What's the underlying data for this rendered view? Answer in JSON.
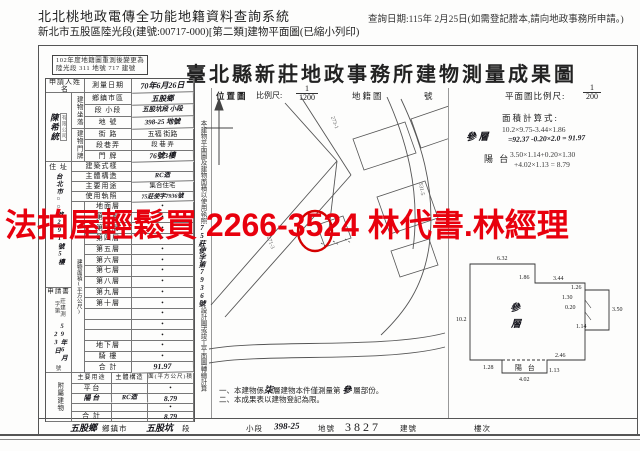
{
  "colors": {
    "watermark_red": "#e8000d",
    "circle_red": "#d40000",
    "ink": "#1c1c1c"
  },
  "page_header": {
    "system_title": "北北桃地政電傳全功能地籍資料查詢系統",
    "subtitle": "新北市五股區陸光段(建號:00717-000)[第二類]建物平面圖(已縮小列印)",
    "query_date": "查詢日期:115年 2月25日(如需登記謄本,請向地政事務所申請。)"
  },
  "watermark": {
    "text": "法拍屋輕鬆買 2266-3524 林代書.林經理"
  },
  "stamp": {
    "line1": "102年度地籍圖重測後變更為",
    "line2": "陸光段 311 地號 717 建號"
  },
  "form": {
    "title": "臺北縣新莊地政事務所建物測量成果圖",
    "map_header": {
      "loc": "位置圖",
      "scale_label": "比例尺:",
      "scale_num": "1",
      "scale_den": "1200",
      "cad": "地籍圖",
      "no": "號"
    },
    "plan_scale": {
      "label": "平面圖比例尺:",
      "num": "1",
      "den": "200"
    },
    "calc": {
      "title": "面積計算式:",
      "floor_label": "參 層",
      "floor_line1": "10.2×9.75-3.44×1.86",
      "floor_line2": "=92.37 -0.20×2.0 = 91.97",
      "balcony_label": "陽 台",
      "balcony_line1": "3.50×1.14+0.20×1.30",
      "balcony_line2": "+4.02×1.13 = 8.79"
    },
    "side_note": {
      "pre": "本建物平面圖及建物面積以使用執照",
      "hand": "75莊使字第7936號",
      "post": "設計圖或竣工平面圖轉繪計算"
    },
    "notes": {
      "n1_pre": "一、本建物係",
      "n1_hand": "柒",
      "n1_mid": "層建物本件僅測量第",
      "n1_hand2": "參",
      "n1_post": "層部份。",
      "n2": "二、本成果表以建物登記為限。"
    }
  },
  "table": {
    "applicant_label": "申請人姓名",
    "applicant_name": "陳希統",
    "applicant_seal": "有限公司",
    "survey_date_label": "測量日期",
    "survey_date_value": "70年6月26日",
    "location_group": "建物坐落",
    "location_rows": [
      {
        "label": "鄉鎮市區",
        "value": "五股鄉"
      },
      {
        "label": "段 小段",
        "value": "五股坑段 小段"
      },
      {
        "label": "地  號",
        "value": "398-25 地號"
      }
    ],
    "door_group": "建物門牌",
    "door_rows": [
      {
        "label": "街  路",
        "value": "五福 街路"
      },
      {
        "label": "段巷弄",
        "value": "段  巷  弄"
      },
      {
        "label": "門  牌",
        "value": "76號3樓"
      }
    ],
    "address_label": "住 址",
    "address_value": "台北市○○路291號5樓",
    "attr_rows": [
      {
        "label": "建築式樣",
        "value": ""
      },
      {
        "label": "主體構造",
        "value": "RC造"
      },
      {
        "label": "主要用途",
        "value": "集合住宅"
      },
      {
        "label": "使用執照",
        "value": "75莊使字7936號"
      }
    ],
    "area_group": "建物面積(平方公尺)",
    "floors": [
      {
        "label": "地面層",
        "value": "•"
      },
      {
        "label": "第二層",
        "value": "•"
      },
      {
        "label": "第三層",
        "value": "•"
      },
      {
        "label": "第四層",
        "value": "•"
      },
      {
        "label": "第五層",
        "value": "•"
      },
      {
        "label": "第六層",
        "value": "•"
      },
      {
        "label": "第七層",
        "value": "•"
      },
      {
        "label": "第八層",
        "value": "•"
      },
      {
        "label": "第九層",
        "value": "•"
      },
      {
        "label": "第十層",
        "value": "•"
      },
      {
        "label": "",
        "value": "•"
      },
      {
        "label": "",
        "value": "•"
      },
      {
        "label": "",
        "value": "•"
      },
      {
        "label": "地下層",
        "value": "•"
      },
      {
        "label": "騎 樓",
        "value": "•"
      },
      {
        "label": "合 計",
        "value": "91.97"
      }
    ],
    "receipt": {
      "form_label": "申請書",
      "prefix": "莊建測字第",
      "date": "59年6月23日",
      "suffix": "號"
    },
    "annex_group": "附屬建物",
    "annex_headers": [
      "主要用途",
      "主體構造",
      "面(平方公尺)積"
    ],
    "annex_rows": [
      {
        "use": "平 台",
        "structure": "",
        "area": "•"
      },
      {
        "use": "陽 台",
        "structure": "RC造",
        "area": "8.79"
      },
      {
        "use": "",
        "structure": "",
        "area": "•"
      },
      {
        "use": "合 計",
        "structure": "",
        "area": "8.79"
      }
    ]
  },
  "plan": {
    "floor_label_1": "參",
    "floor_label_2": "層",
    "balcony_label": "陽 台",
    "dims": {
      "top": "6.32",
      "notch_h": "1.86",
      "notch_w": "3.44",
      "r1": "1.26",
      "r2": "1.30",
      "r3": "0.20",
      "r4": "3.50",
      "r5": "1.14",
      "left": "10.2",
      "bottom_right": "2.46",
      "b1": "1.28",
      "b2": "1.13",
      "balcony_w": "4.02"
    }
  },
  "map_labels": {
    "l1": "273-1",
    "l2": "271-3",
    "l3": "531-5"
  },
  "footer": {
    "v1": "五股鄉",
    "l1": "鄉鎮市",
    "v2": "五股坑",
    "l2": "段",
    "l3": "小段",
    "v4": "398-25",
    "l4": "地號",
    "v5": "3827",
    "l5": "建號",
    "l6": "樓次"
  }
}
